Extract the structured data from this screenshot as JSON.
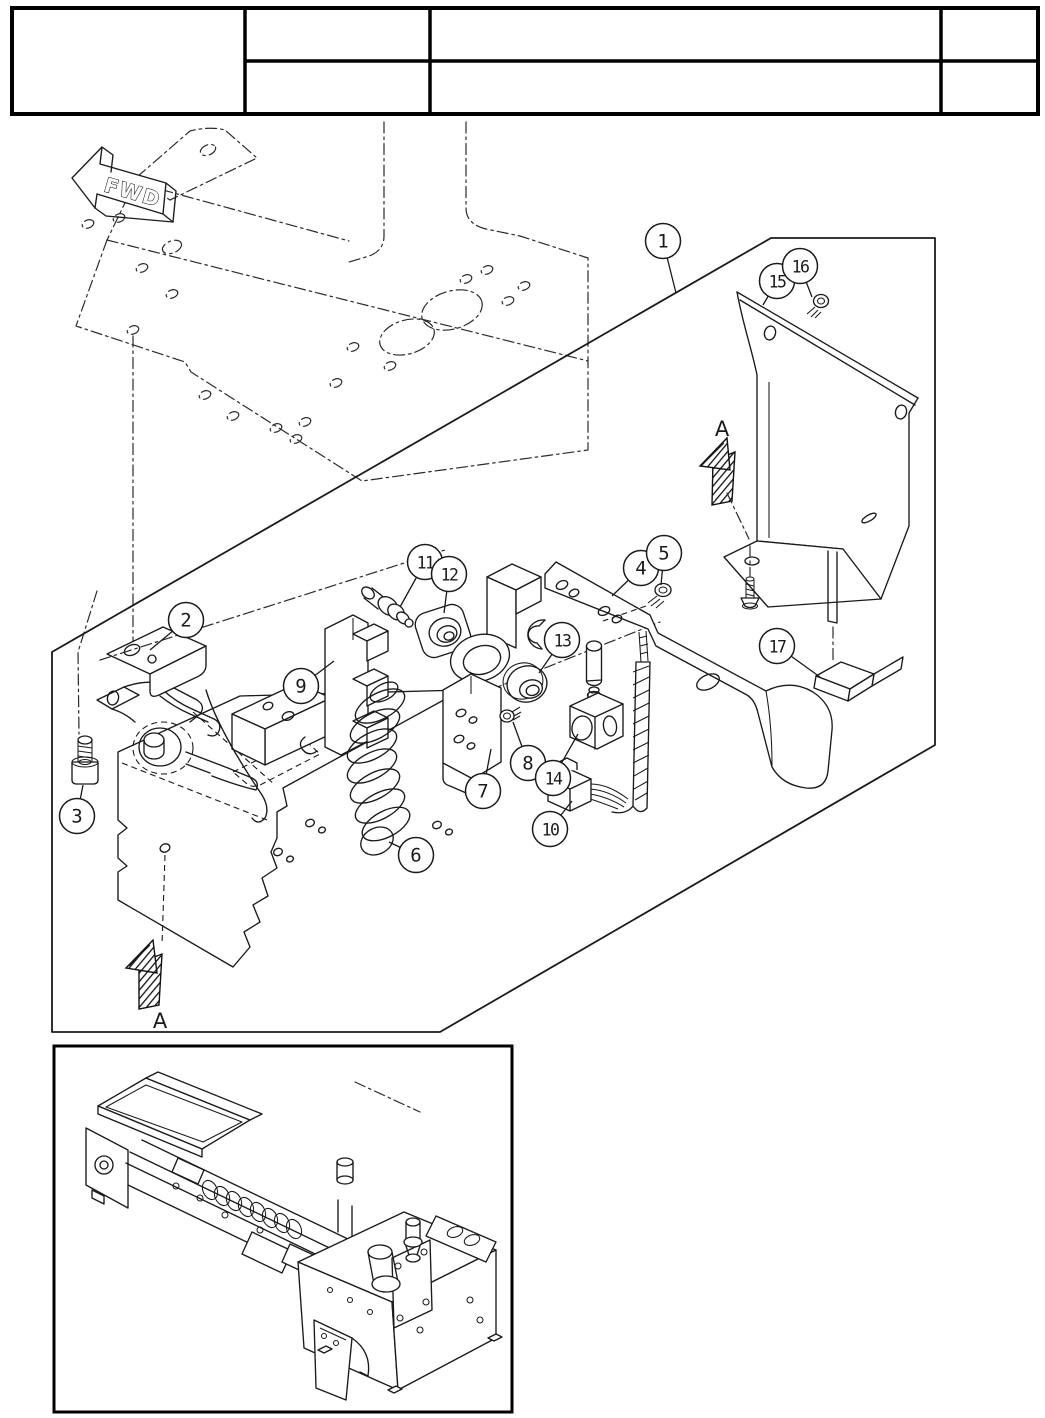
{
  "page": {
    "background": "#ffffff",
    "ink": "#1a1a1a"
  },
  "header_table": {
    "rows": 2,
    "columns": 4,
    "cells": [
      "",
      "",
      "",
      "",
      "",
      "",
      ""
    ]
  },
  "diagram": {
    "direction_label": "FWD",
    "upper_view_label": "A",
    "lower_view_label": "A",
    "callout_style": {
      "radius": 17.5
    },
    "callouts": [
      {
        "number": "1",
        "cx": 663,
        "cy": 241,
        "tx": 676,
        "ty": 293
      },
      {
        "number": "2",
        "cx": 186,
        "cy": 620,
        "tx": 150,
        "ty": 650
      },
      {
        "number": "3",
        "cx": 77,
        "cy": 816,
        "tx": 83,
        "ty": 785
      },
      {
        "number": "4",
        "cx": 641,
        "cy": 568,
        "tx": 612,
        "ty": 596
      },
      {
        "number": "5",
        "cx": 664,
        "cy": 553,
        "tx": 661,
        "ty": 585
      },
      {
        "number": "6",
        "cx": 416,
        "cy": 855,
        "tx": 389,
        "ty": 842
      },
      {
        "number": "7",
        "cx": 483,
        "cy": 791,
        "tx": 491,
        "ty": 749
      },
      {
        "number": "8",
        "cx": 528,
        "cy": 763,
        "tx": 513,
        "ty": 722
      },
      {
        "number": "9",
        "cx": 301,
        "cy": 686,
        "tx": 334,
        "ty": 661
      },
      {
        "number": "10",
        "cx": 550,
        "cy": 829,
        "tx": 572,
        "ty": 801
      },
      {
        "number": "11",
        "cx": 425,
        "cy": 562,
        "tx": 400,
        "ty": 607
      },
      {
        "number": "12",
        "cx": 449,
        "cy": 574,
        "tx": 444,
        "ty": 613
      },
      {
        "number": "13",
        "cx": 562,
        "cy": 640,
        "tx": 539,
        "ty": 673
      },
      {
        "number": "14",
        "cx": 553,
        "cy": 778,
        "tx": 578,
        "ty": 734
      },
      {
        "number": "15",
        "cx": 777,
        "cy": 281,
        "tx": 763,
        "ty": 305
      },
      {
        "number": "16",
        "cx": 800,
        "cy": 266,
        "tx": 812,
        "ty": 297
      },
      {
        "number": "17",
        "cx": 777,
        "cy": 646,
        "tx": 820,
        "ty": 677
      }
    ]
  }
}
